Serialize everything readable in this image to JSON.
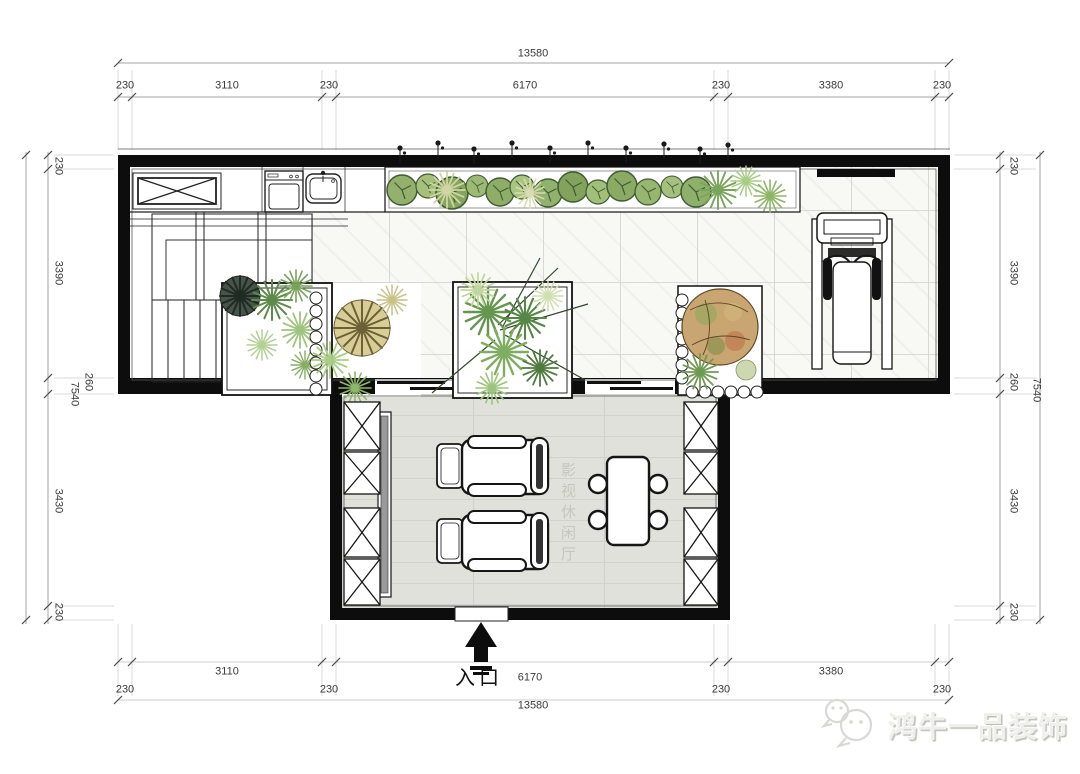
{
  "labels": {
    "entrance": "入口",
    "room": "影视休闲厅",
    "watermark": "鸿牛一品装饰"
  },
  "dimensions": {
    "top": {
      "overall": "13580",
      "segments": [
        "230",
        "3110",
        "230",
        "6170",
        "230",
        "3380",
        "230"
      ]
    },
    "bottom": {
      "overall": "13580",
      "segments": [
        "230",
        "3110",
        "230",
        "6170",
        "230",
        "3380",
        "230"
      ]
    },
    "left": {
      "overall": "7540",
      "segments": [
        "230",
        "3390",
        "260",
        "3430",
        "230"
      ]
    },
    "right": {
      "overall": "7540",
      "segments": [
        "230",
        "3390",
        "260",
        "3430",
        "230"
      ]
    }
  },
  "icons": {
    "entrance_arrow": "up-arrow",
    "watermark_logo": "wechat-bubbles",
    "fixtures": [
      "storage-cabinet",
      "washing-machine",
      "sink",
      "staircase",
      "planter-strip",
      "planter-box",
      "garden-bed",
      "treadmill",
      "tv-panel",
      "recliner-sofa",
      "side-table",
      "dining-table",
      "dining-chair",
      "sliding-door",
      "x-cabinet"
    ]
  },
  "colors": {
    "wall": "#0d0d0d",
    "terrace_tile": "#f8f8f5",
    "living_floor": "#e0e1da",
    "plant_green": "#7fae60",
    "plant_dark": "#2f3a32",
    "plant_autumn": "#c9a671",
    "dim_text": "#3a3a3a",
    "watermark_gray": "#efefec"
  }
}
